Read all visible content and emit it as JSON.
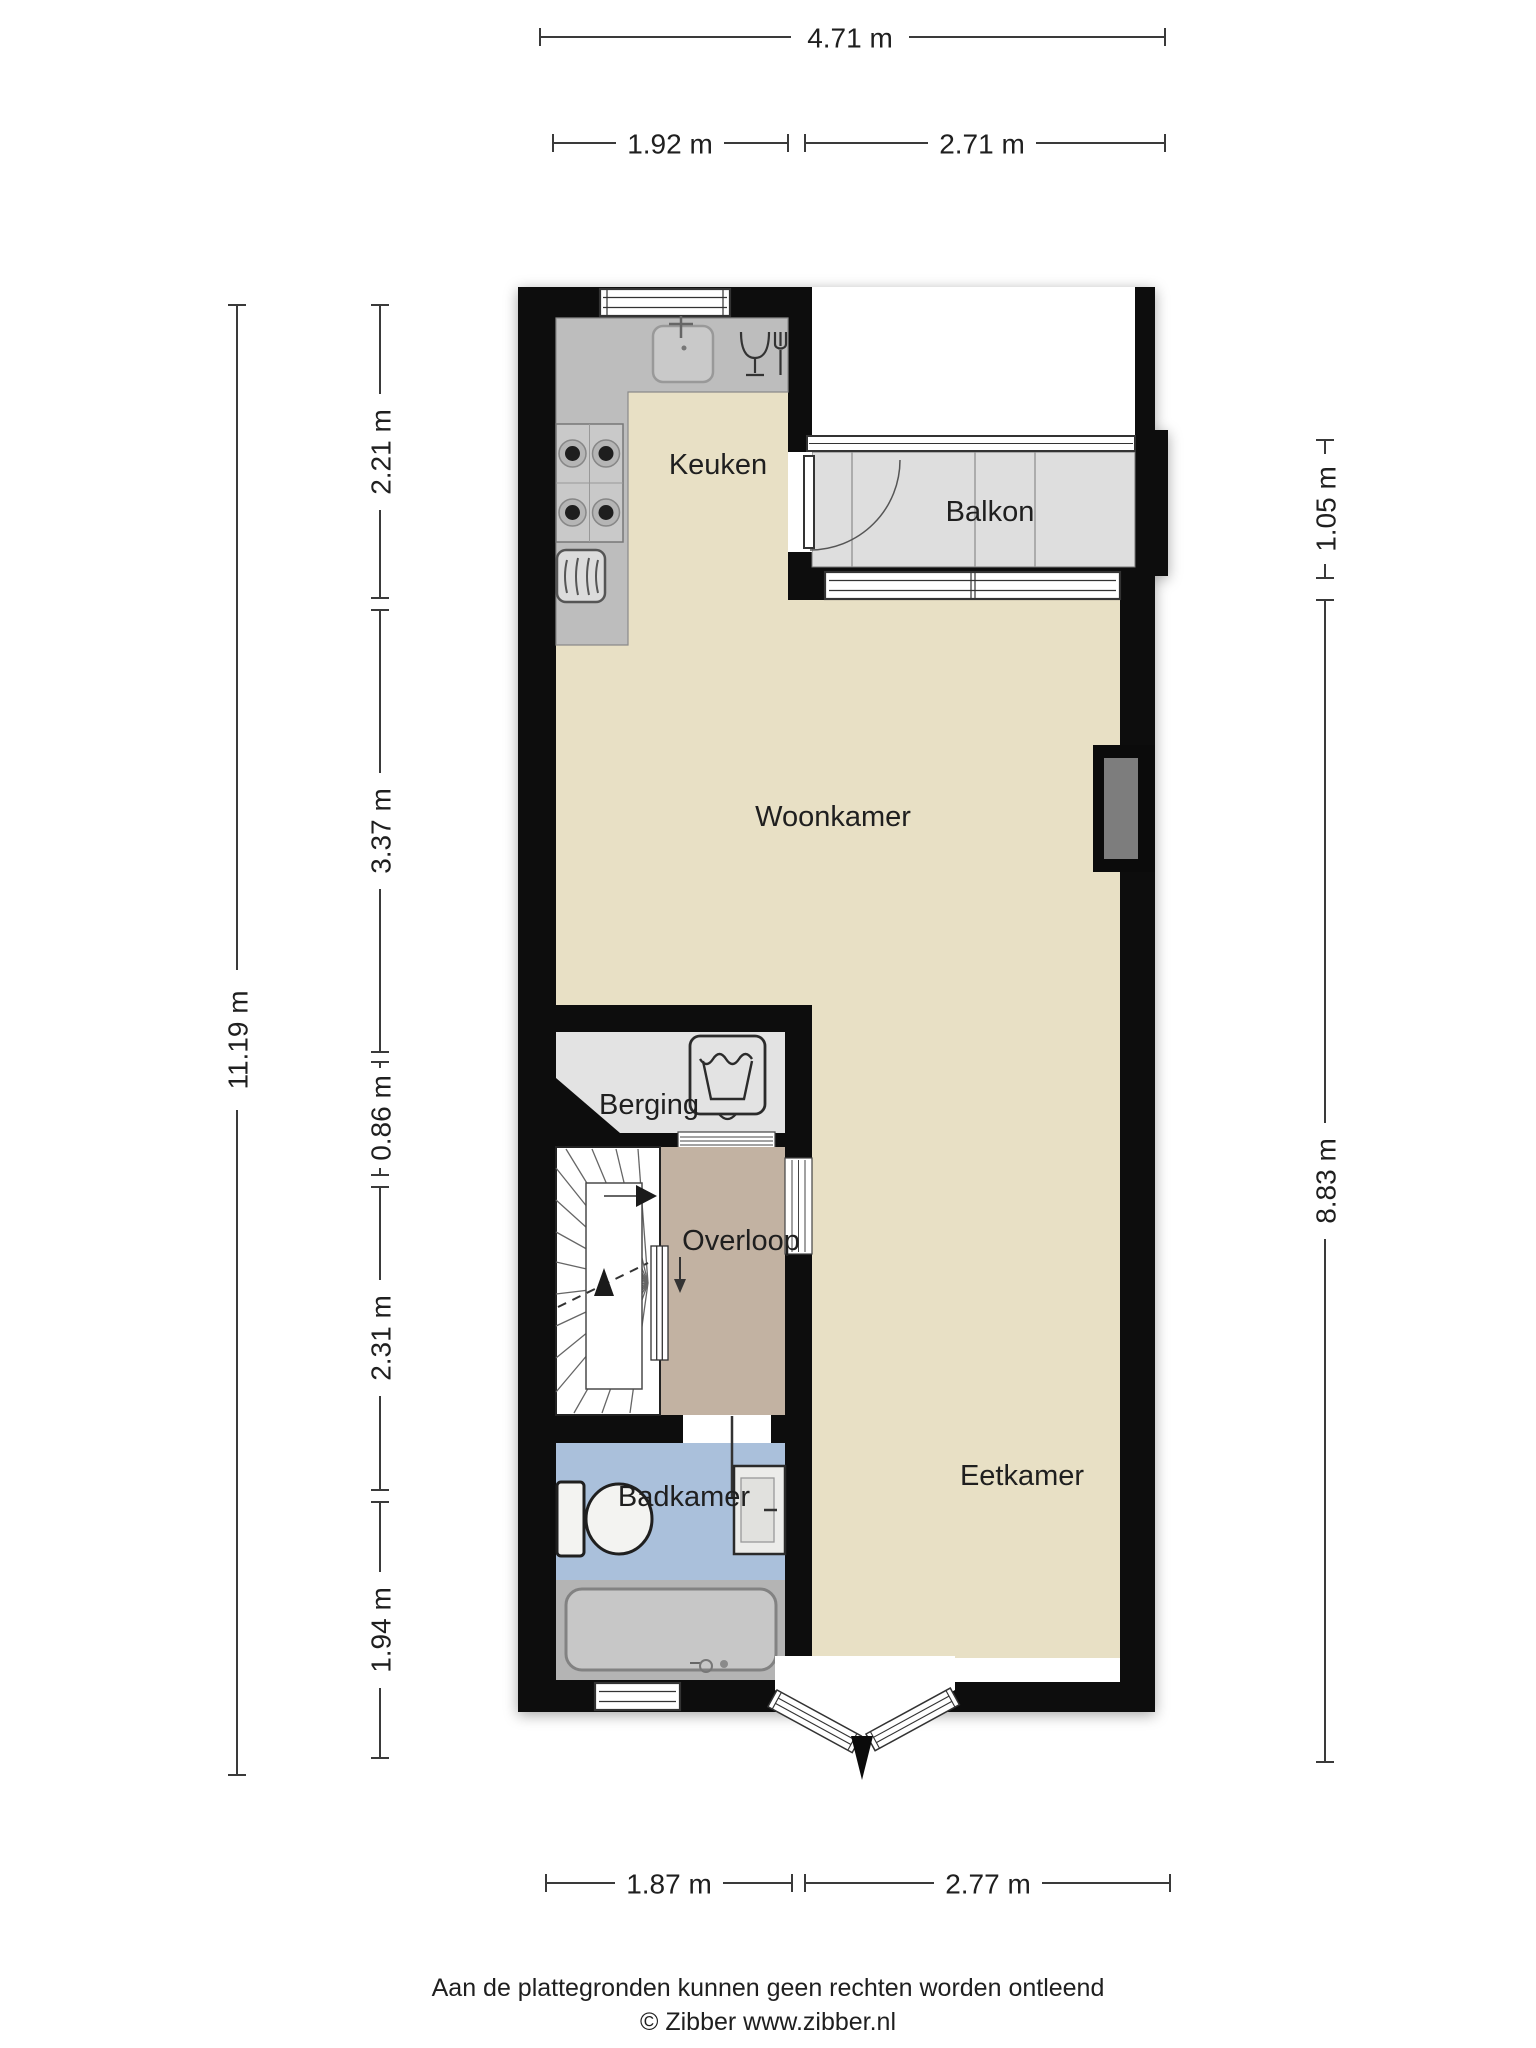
{
  "rooms": {
    "keuken": "Keuken",
    "balkon": "Balkon",
    "woonkamer": "Woonkamer",
    "berging": "Berging",
    "overloop": "Overloop",
    "badkamer": "Badkamer",
    "eetkamer": "Eetkamer"
  },
  "dims": {
    "top_total": "4.71 m",
    "top_1": "1.92 m",
    "top_2": "2.71 m",
    "left_total": "11.19 m",
    "left_1": "2.21 m",
    "left_2": "3.37 m",
    "left_3": "0.86 m",
    "left_4": "2.31 m",
    "left_5": "1.94 m",
    "right_1": "1.05 m",
    "right_2": "8.83 m",
    "bottom_1": "1.87 m",
    "bottom_2": "2.77 m"
  },
  "footer": {
    "disclaimer": "Aan de plattegronden kunnen geen rechten worden ontleend",
    "credit": "© Zibber www.zibber.nl"
  },
  "colors": {
    "wall": "#0b0b0b",
    "floor_main": "#e8e0c5",
    "floor_balkon": "#dedede",
    "floor_berging": "#e3e3e3",
    "floor_overloop": "#c2b2a2",
    "floor_badkamer": "#aac0db",
    "bath_zone": "#b4b4b4",
    "counter": "#bdbdbd",
    "chimney": "#7d7d7d"
  },
  "icons": [
    "sink-icon",
    "dishwasher-icon",
    "stove-icon",
    "oven-icon",
    "washing-machine-icon",
    "toilet-icon",
    "washbasin-icon",
    "bathtub-icon",
    "stairs-up-arrow-icon",
    "down-arrow-icon"
  ]
}
